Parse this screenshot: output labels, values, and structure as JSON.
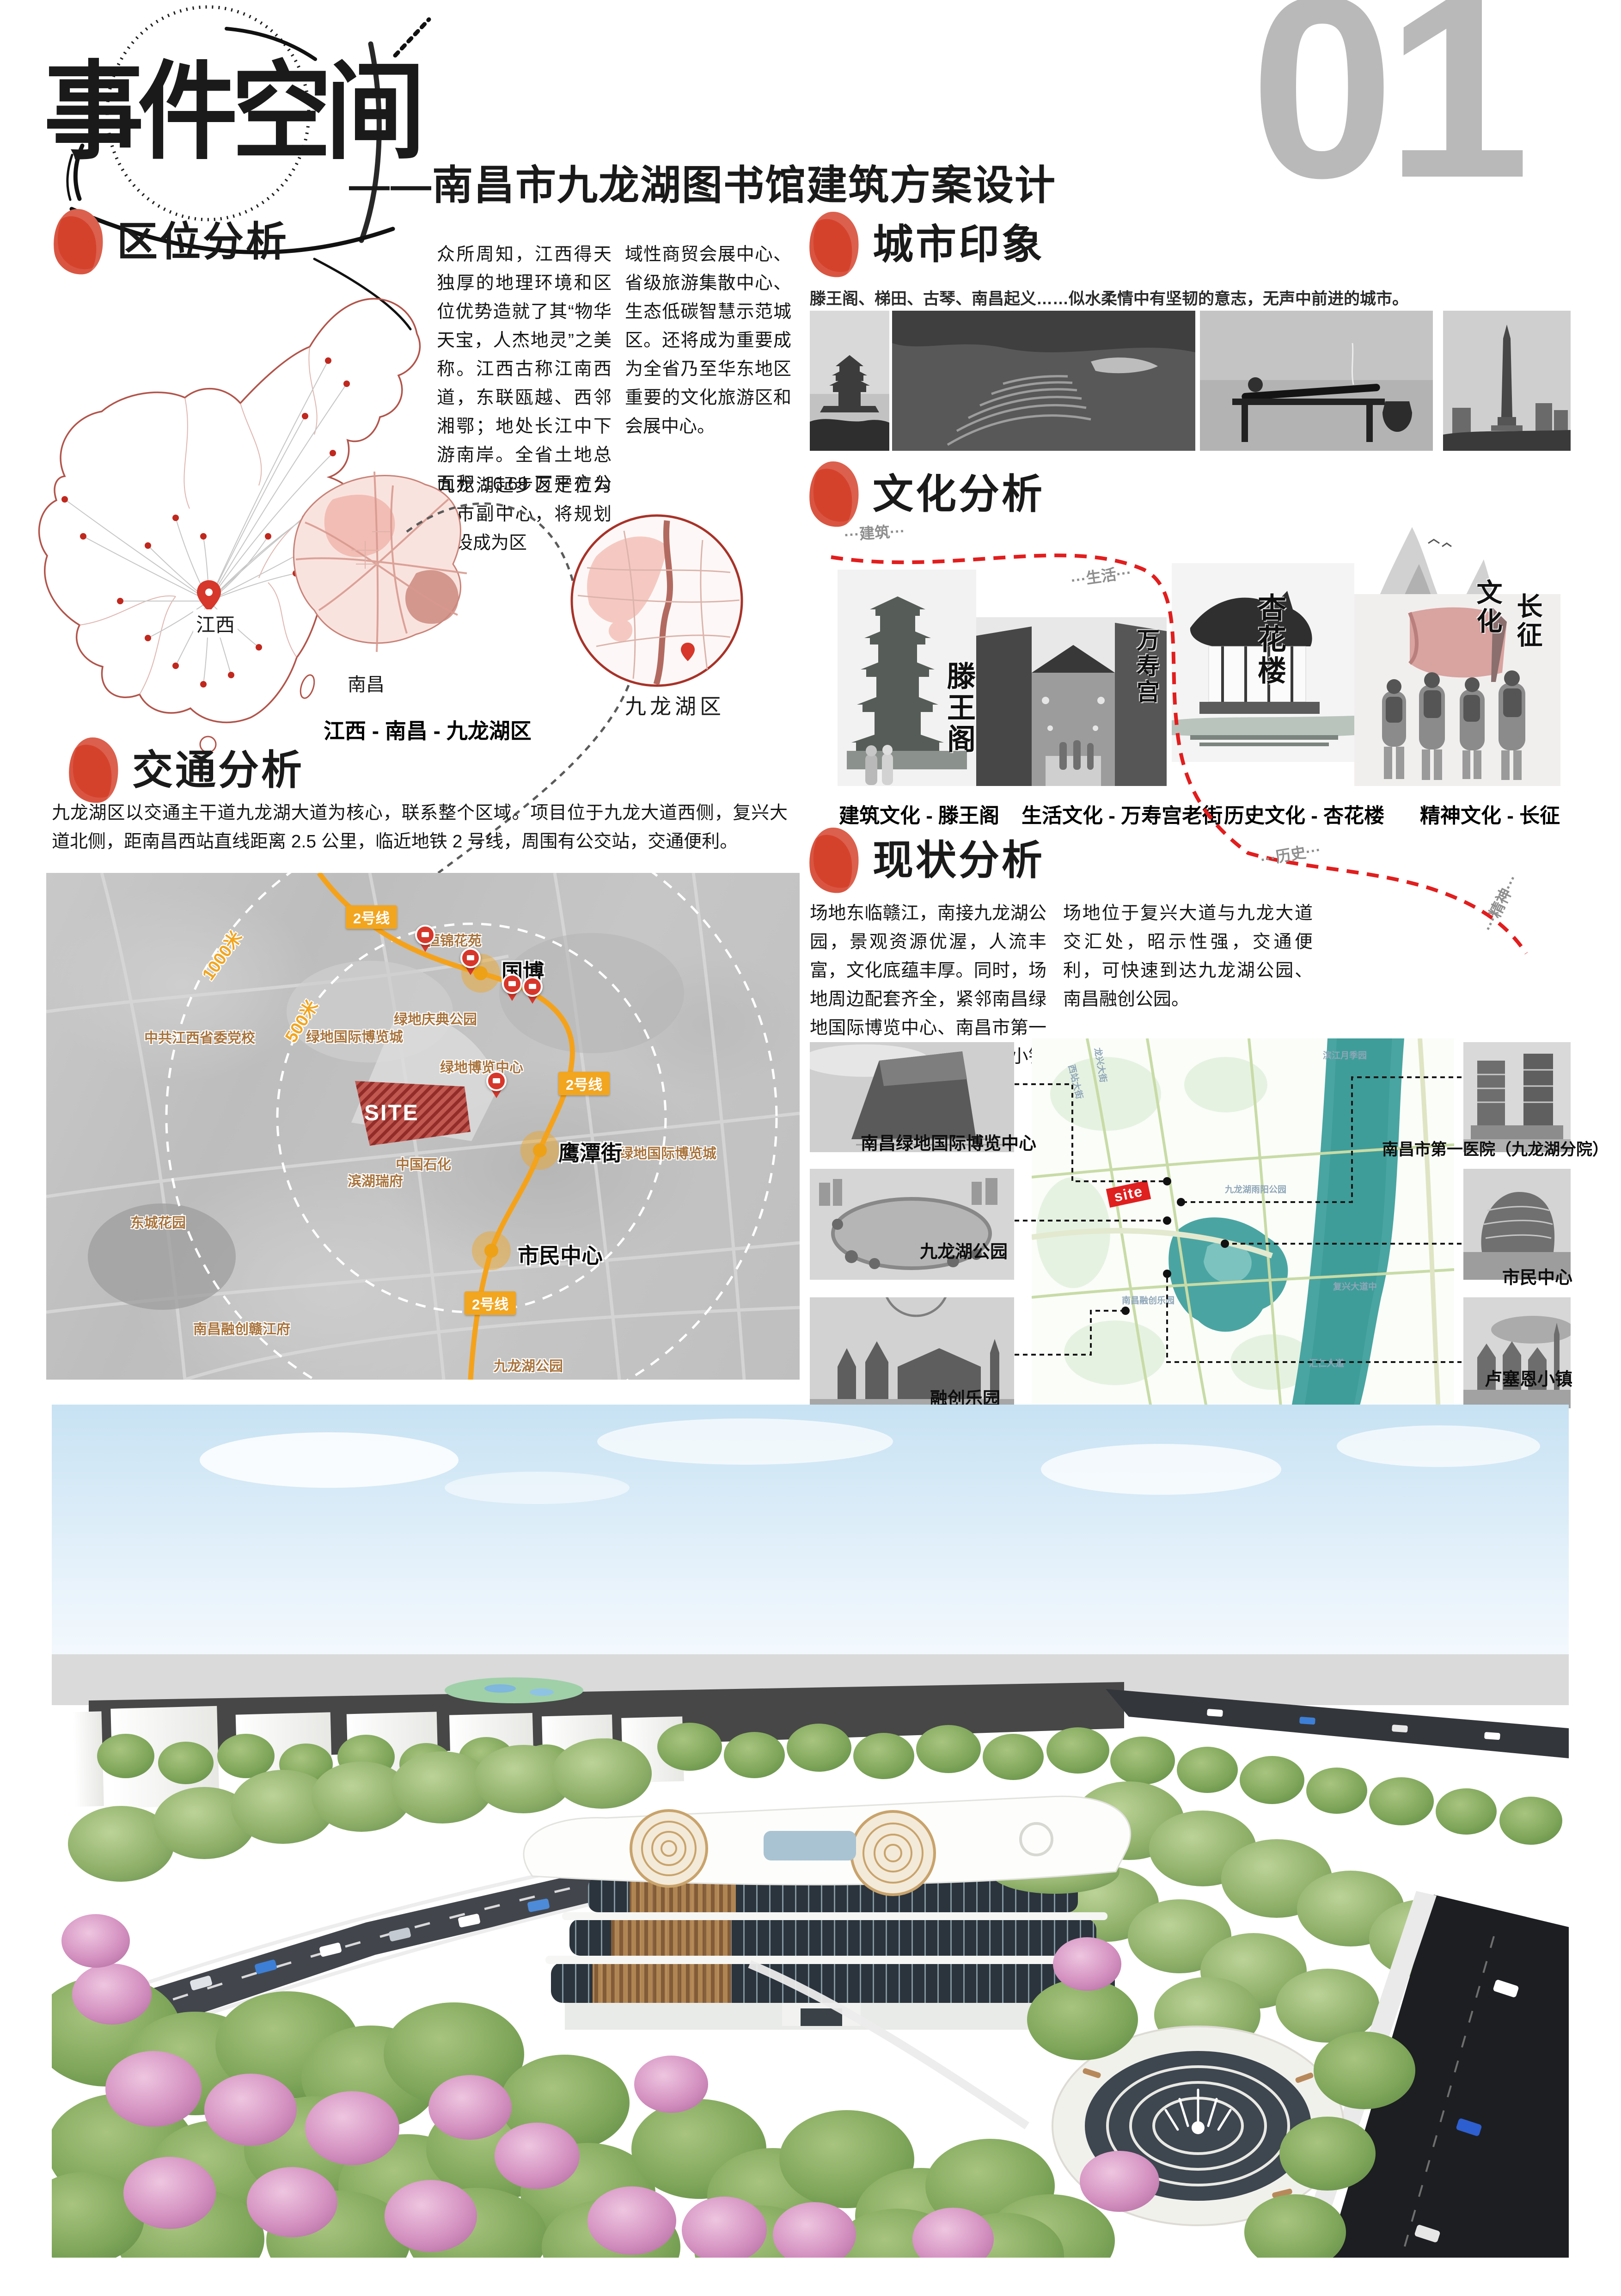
{
  "header": {
    "title": "事件空间",
    "subtitle": "——南昌市九龙湖图书馆建筑方案设计",
    "page_number": "01"
  },
  "colors": {
    "accent_red": "#D5422C",
    "metro_orange": "#F2A51F",
    "site_red": "#A3302A",
    "river_teal": "#4AA5A2",
    "label_tan": "#A8733C",
    "page_number_gray": "#B9B9B9",
    "route_red": "#E21D1D"
  },
  "icons": {
    "section_marker": "red-ink-seal",
    "bus_stop": "bus-stop-pin",
    "metro_station": "station-glow-dot",
    "site_pin": "location-pin"
  },
  "location": {
    "heading": "区位分析",
    "paragraph_1": "众所周知，江西得天独厚的地理环境和区位优势造就了其“物华天宝，人杰地灵”之美称。江西古称江南西道，东联瓯越、西邻湘鄂；地处长江中下游南岸。全省土地总面积 16.69 万平方公里。",
    "paragraph_2": "九龙湖起步区定位为城市副中心，将规划建设成为区",
    "paragraph_3": "域性商贸会展中心、省级旅游集散中心、生态低碳智慧示范城区。还将成为重要成为全省乃至华东地区重要的文化旅游区和会展中心。",
    "map_label_province": "江西",
    "map_label_city": "南昌",
    "inset_label": "九龙湖区",
    "caption": "江西 - 南昌 - 九龙湖区"
  },
  "city": {
    "heading": "城市印象",
    "caption": "滕王阁、梯田、古琴、南昌起义……似水柔情中有坚韧的意志，无声中前进的城市。"
  },
  "culture": {
    "heading": "文化分析",
    "route_labels": [
      "···建筑···",
      "···生活···",
      "···历史···",
      "···精神···"
    ],
    "items": [
      {
        "caption": "建筑文化 - 滕王阁",
        "calligraphy": "滕王阁"
      },
      {
        "caption": "生活文化 - 万寿宫老街",
        "calligraphy_cols": [
          "万寿宫",
          "老街"
        ]
      },
      {
        "caption": "历史文化 - 杏花楼",
        "calligraphy": "杏花楼"
      },
      {
        "caption": "精神文化 - 长征",
        "calligraphy_cols": [
          "文化",
          "长征"
        ]
      }
    ]
  },
  "traffic": {
    "heading": "交通分析",
    "paragraph": "九龙湖区以交通主干道九龙湖大道为核心，联系整个区域。项目位于九龙大道西侧，复兴大道北侧，距南昌西站直线距离 2.5 公里，临近地铁 2 号线，周围有公交站，交通便利。",
    "site_label": "SITE",
    "metro_badge": "2号线",
    "radius_labels": [
      "1000米",
      "500米"
    ],
    "stations": [
      "国博",
      "鹰潭街",
      "市民中心"
    ],
    "places": [
      "恒锦花苑",
      "中共江西省委党校",
      "绿地庆典公园",
      "绿地国际博览城",
      "绿地博览中心",
      "绿地国际博览城",
      "中国石化",
      "滨湖瑞府",
      "东城花园",
      "南昌融创赣江府",
      "九龙湖公园"
    ]
  },
  "status": {
    "heading": "现状分析",
    "paragraph_1": "场地东临赣江，南接九龙湖公园，景观资源优渥，人流丰富，文化底蕴丰厚。同时，场地周边配套齐全，紧邻南昌绿地国际博览中心、南昌市第一医院、市民中心、卢塞恩小镇等。",
    "paragraph_2": "场地位于复兴大道与九龙大道交汇处，昭示性强，交通便利，可快速到达九龙湖公园、南昌融创公园。",
    "site_tag": "site",
    "photos_left": [
      "南昌绿地国际博览中心",
      "九龙湖公园",
      "融创乐园"
    ],
    "photos_right": [
      "南昌市第一医院（九龙湖分院）",
      "市民中心",
      "卢塞恩小镇"
    ],
    "streets": [
      "滨江月季园",
      "西站大街",
      "龙兴大街",
      "九龙湖雨阳公园",
      "复兴大道中",
      "汇仁大道",
      "南昌融创乐园"
    ]
  }
}
